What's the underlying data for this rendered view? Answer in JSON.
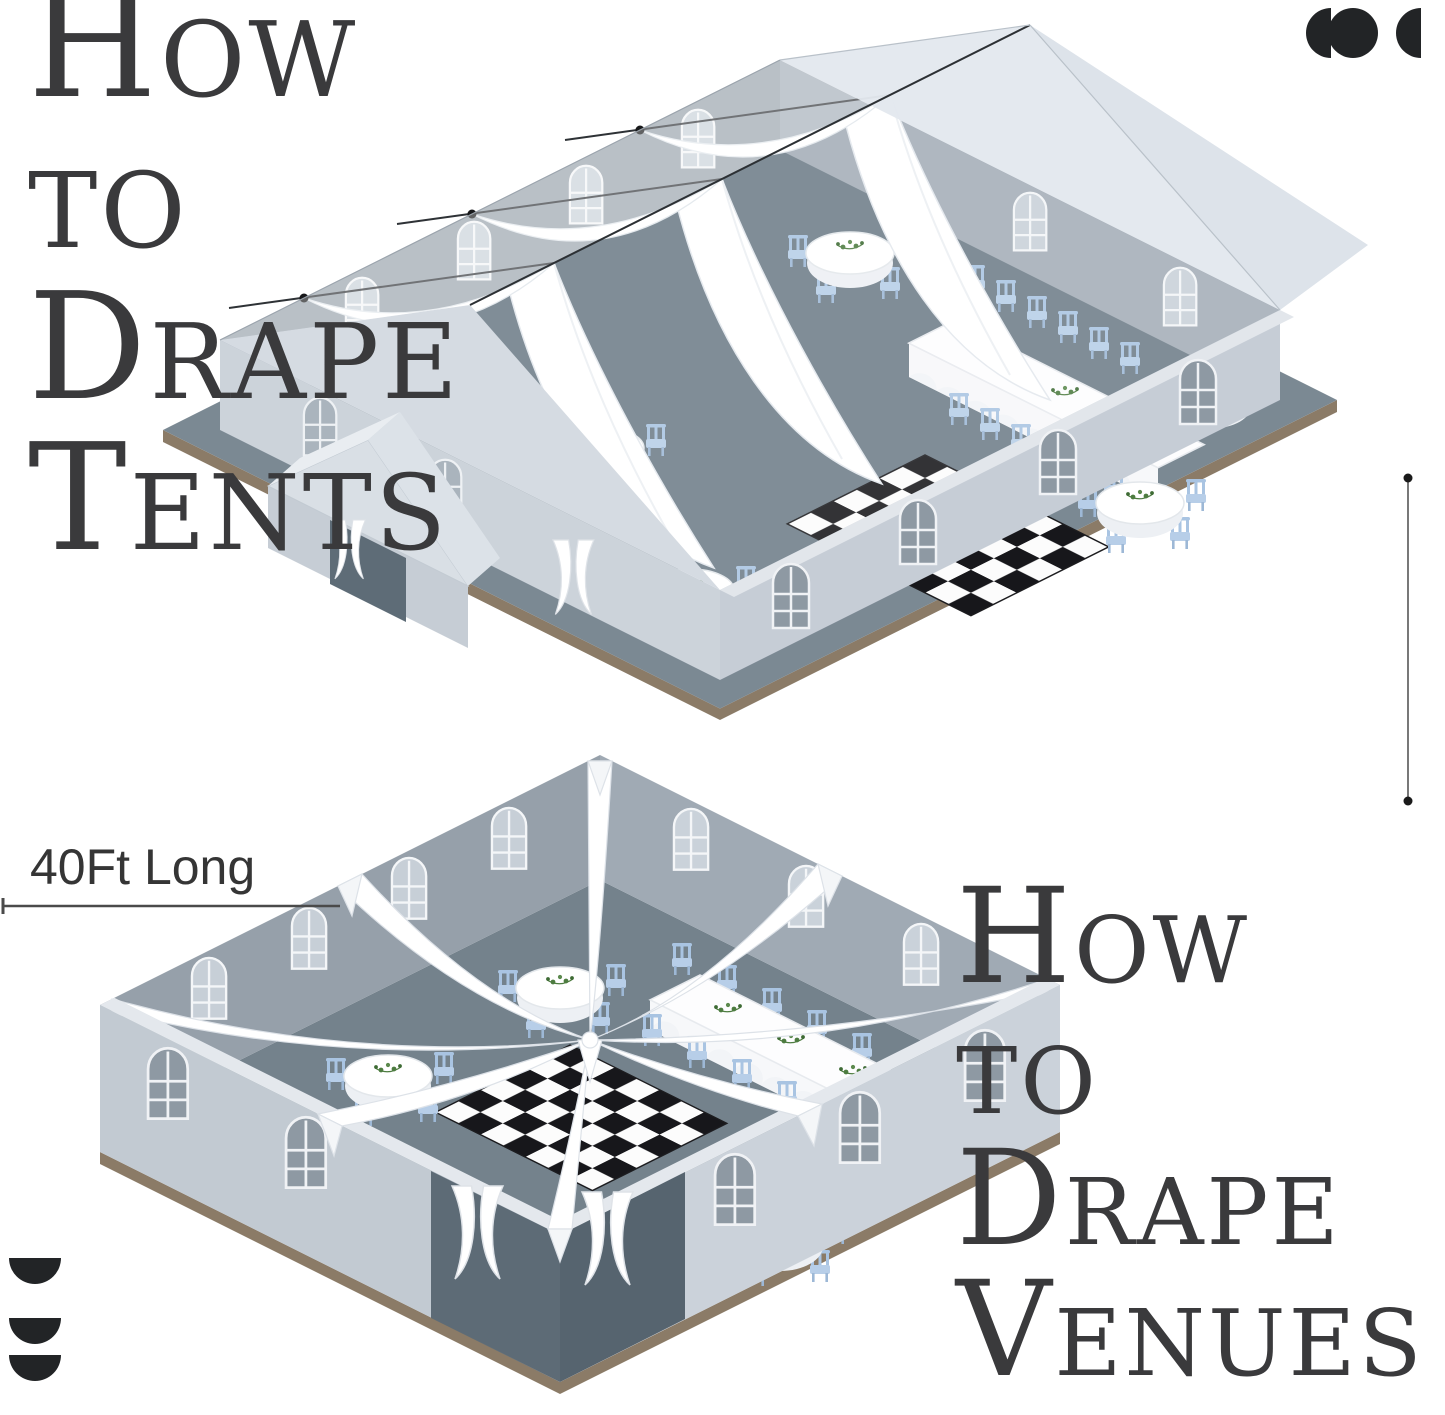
{
  "canvas": {
    "width": 1445,
    "height": 1415,
    "background": "#ffffff"
  },
  "title_tents": {
    "line1": "How",
    "line2": "to",
    "line3": "Drape",
    "line4": "Tents",
    "color": "#3a3a3c"
  },
  "title_venues": {
    "line1": "How",
    "line2": "to",
    "line3": "Drape",
    "line4": "Venues",
    "color": "#3a3a3c"
  },
  "measurement": {
    "label": "40Ft Long",
    "text_color": "#353535",
    "line_color": "#4a4a4a"
  },
  "icons": {
    "top_right": "logo-mark-semicircle-circle-semicircle",
    "bottom_left": "logo-mark-three-stacked-semicircles",
    "color": "#222426"
  },
  "illustration_colors": {
    "floor_slate": "#6f7e89",
    "platform_top": "#7b8993",
    "platform_edge_brown": "#8b7b67",
    "wall_outer_light": "#c6cdd6",
    "wall_inner_gray": "#98a2ac",
    "window_dark": "#8e99a3",
    "window_light": "#c9d1d9",
    "drape_white": "#ffffff",
    "drape_shade": "#e3e8ed",
    "chair_blue": "#a9c4e2",
    "checker_black": "#17171b",
    "checker_white": "#fcfcfc",
    "foliage_green": "#4d7c40",
    "cable_dark": "#2e3236"
  }
}
